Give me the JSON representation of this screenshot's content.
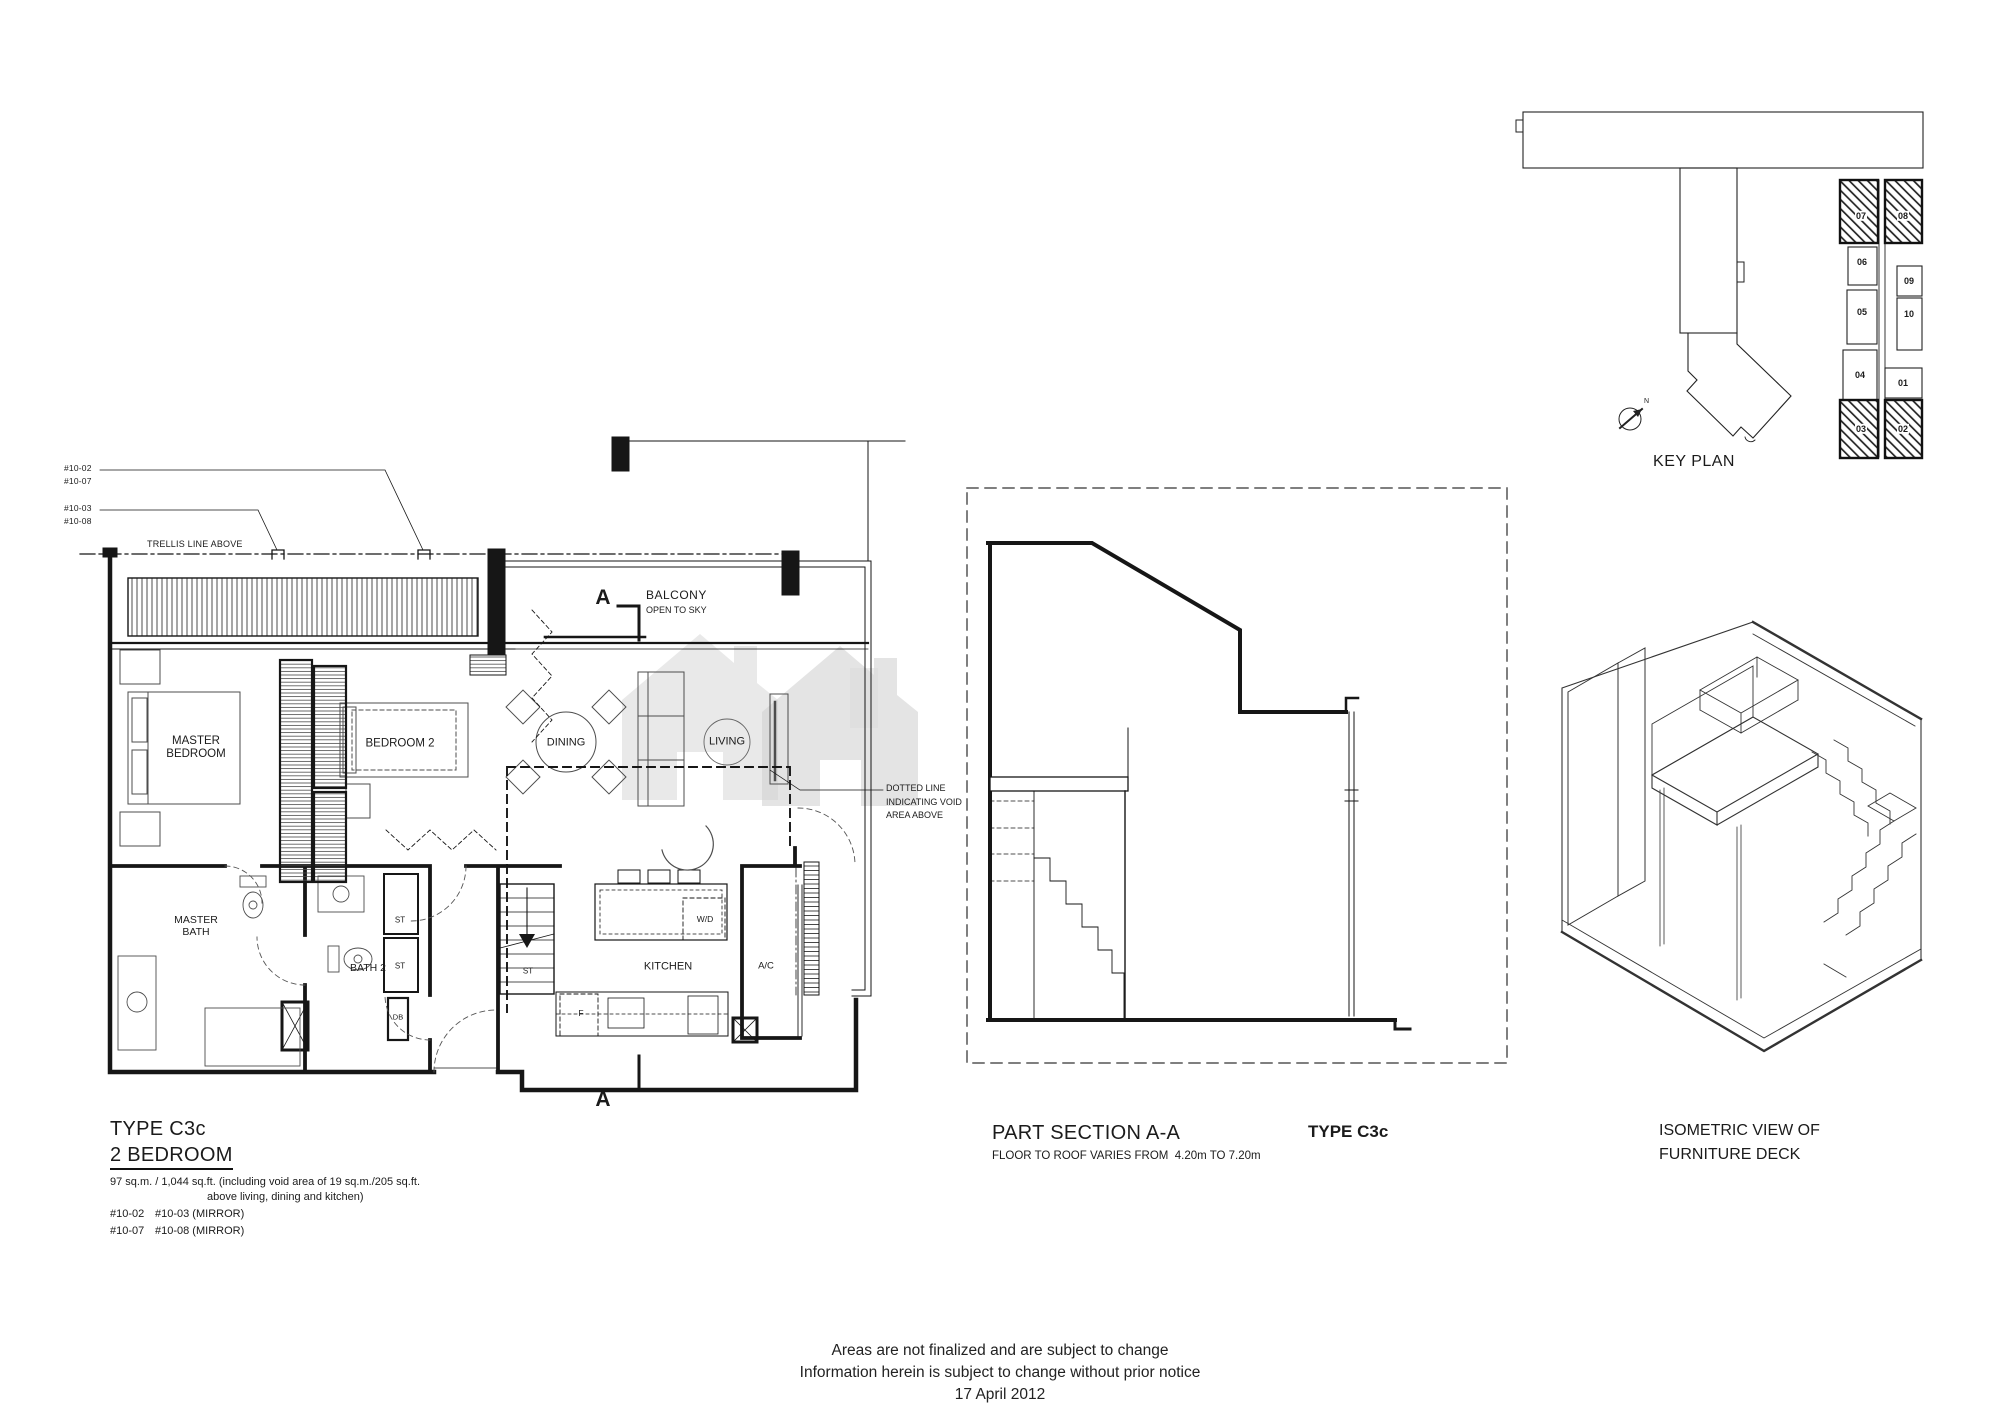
{
  "plan": {
    "ref_top1a": "#10-02",
    "ref_top1b": "#10-07",
    "ref_top2a": "#10-03",
    "ref_top2b": "#10-08",
    "trellis_note": "TRELLIS LINE ABOVE",
    "balcony": "BALCONY",
    "balcony_sub": "OPEN TO SKY",
    "section_marker": "A",
    "void_note": "DOTTED LINE INDICATING VOID AREA ABOVE",
    "rooms": {
      "master_bedroom": "MASTER BEDROOM",
      "bedroom2": "BEDROOM 2",
      "dining": "DINING",
      "living": "LIVING",
      "master_bath": "MASTER BATH",
      "bath2": "BATH 2",
      "kitchen": "KITCHEN",
      "wd": "W/D",
      "ac": "A/C",
      "st": "ST",
      "f": "F",
      "db": "DB"
    }
  },
  "info_block": {
    "type": "TYPE C3c",
    "bedrooms": "2 BEDROOM",
    "area1": "97 sq.m. / 1,044 sq.ft. (including void area of 19 sq.m./205 sq.ft.",
    "area2": "above living, dining and kitchen)",
    "u11": "#10-02",
    "u12": "#10-03 (MIRROR)",
    "u21": "#10-07",
    "u22": "#10-08 (MIRROR)"
  },
  "section": {
    "title": "PART SECTION A-A",
    "subtitle": "FLOOR TO ROOF VARIES FROM  4.20m TO 7.20m",
    "type": "TYPE C3c"
  },
  "key_plan": {
    "title": "KEY PLAN",
    "north": "N",
    "units": {
      "u07": "07",
      "u08": "08",
      "u06": "06",
      "u09": "09",
      "u05": "05",
      "u10": "10",
      "u04": "04",
      "u01": "01",
      "u03": "03",
      "u02": "02"
    }
  },
  "isometric": {
    "line1": "ISOMETRIC VIEW OF",
    "line2": "FURNITURE DECK"
  },
  "footer": {
    "line1": "Areas are not finalized and are subject to change",
    "line2": "Information herein is subject to change without prior notice",
    "line3": "17 April 2012"
  }
}
